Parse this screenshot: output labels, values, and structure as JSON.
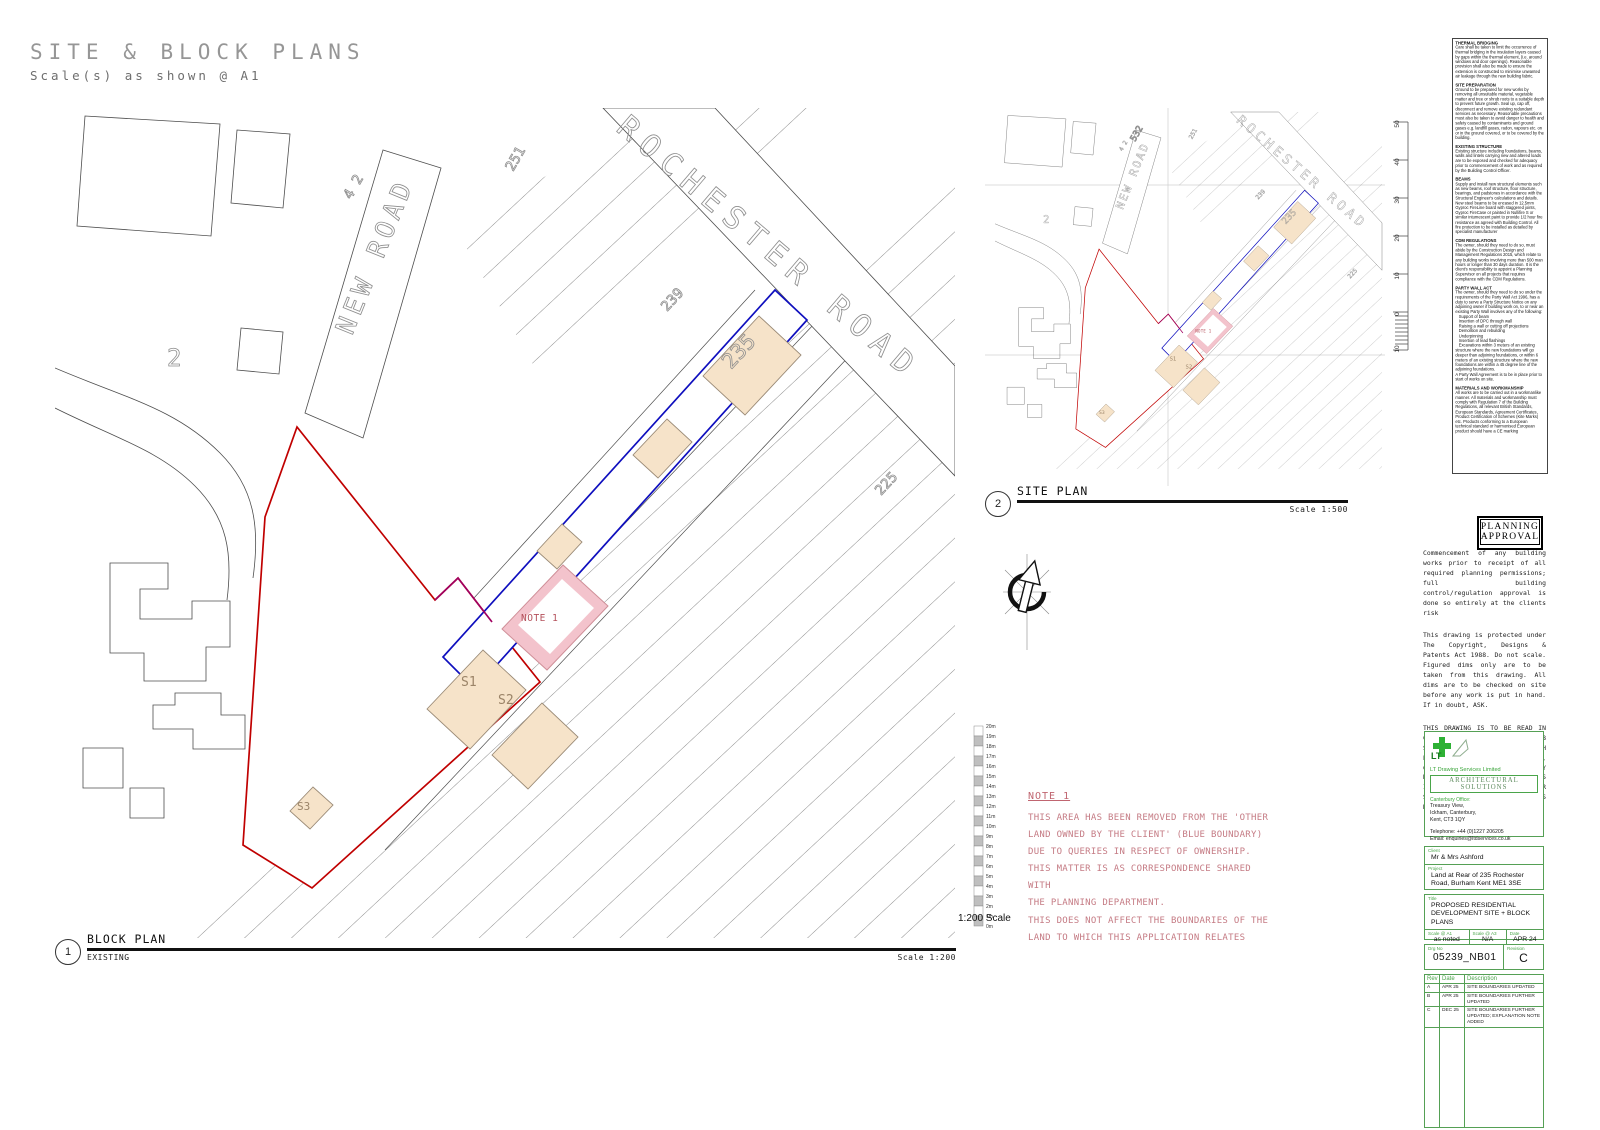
{
  "header": {
    "title": "SITE & BLOCK PLANS",
    "subtitle": "Scale(s) as shown @ A1"
  },
  "colors": {
    "application_boundary_red": "#c00000",
    "other_land_boundary_blue": "#0f0fbe",
    "parcel_fill_beige": "#f6e3c9",
    "note_area_pink": "#f3c3cc",
    "title_block_green": "#55a055",
    "note_text_pink": "#c57b84"
  },
  "block_plan": {
    "callout_number": "1",
    "title": "BLOCK PLAN",
    "status": "EXISTING",
    "scale": "Scale 1:200",
    "road_labels": {
      "new_road": "NEW ROAD",
      "rochester_road": "ROCHESTER ROAD"
    },
    "house_numbers": {
      "n2": "2",
      "n42": "4 2",
      "n251": "251",
      "n239": "239",
      "n235": "235",
      "n225": "225"
    },
    "plot_labels": {
      "s1": "S1",
      "s2": "S2",
      "s3": "S3",
      "note1": "NOTE 1"
    }
  },
  "site_plan": {
    "callout_number": "2",
    "title": "SITE PLAN",
    "scale": "Scale 1:500",
    "extra_house_number": "532",
    "scale_bar_ticks": [
      "50",
      "40",
      "30",
      "20",
      "10",
      "0",
      "10"
    ]
  },
  "north_arrow": {
    "label": "N"
  },
  "scale_bar": {
    "label": "1:200 Scale",
    "ticks": [
      "20m",
      "19m",
      "18m",
      "17m",
      "16m",
      "15m",
      "14m",
      "13m",
      "12m",
      "11m",
      "10m",
      "9m",
      "8m",
      "7m",
      "6m",
      "5m",
      "4m",
      "3m",
      "2m",
      "1m",
      "0m"
    ]
  },
  "note1": {
    "title": "NOTE 1",
    "body": "THIS AREA HAS BEEN REMOVED FROM THE 'OTHER\nLAND OWNED BY THE CLIENT' (BLUE BOUNDARY)\nDUE TO QUERIES IN RESPECT OF OWNERSHIP.\nTHIS MATTER IS AS CORRESPONDENCE SHARED WITH\nTHE PLANNING DEPARTMENT.\nTHIS DOES NOT AFFECT THE BOUNDARIES OF THE\nLAND TO WHICH THIS APPLICATION RELATES"
  },
  "notes_panel": {
    "sections": [
      {
        "heading": "THERMAL BRIDGING",
        "body": "Care shall be taken to limit the occurrence of thermal bridging in the insulation layers caused by gaps within the thermal element, (i.e. around windows and door openings). Reasonable provision shall also be made to ensure the extension is constructed to minimise unwanted air leakage through the new building fabric."
      },
      {
        "heading": "SITE PREPARATION",
        "body": "Ground to be prepared for new works by removing all unsuitable material, vegetable matter and tree or shrub roots to a suitable depth to prevent future growth. Seal up, cap off, disconnect and remove existing redundant services as necessary. Reasonable precautions must also be taken to avoid danger to health and safety caused by contaminants and ground gases e.g. landfill gases, radon, vapours etc. on or in the ground covered, or to be covered by the building."
      },
      {
        "heading": "EXISTING STRUCTURE",
        "body": "Existing structure including foundations, beams, walls and lintels carrying new and altered loads are to be exposed and checked for adequacy prior to commencement of work and as required by the Building Control Officer."
      },
      {
        "heading": "BEAMS",
        "body": "Supply and install new structural elements such as new beams, roof structure, floor structure, bearings, and padstones in accordance with the Structural Engineer's calculations and details. New steel beams to be encased in 12.5mm Gyproc FireLine board with staggered joints, Gyproc FireCase or painted in Nullifire S or similar intumescent paint to provide 1/2 hour fire resistance as agreed with Building Control. All fire protection to be installed as detailed by specialist manufacturer"
      },
      {
        "heading": "CDM REGULATIONS",
        "body": "The owner, should they need to do so, must abide by the Construction Design and Management Regulations 2015, which relate to any building works involving more than 500 man hours or longer than 30 days duration. It is the client's responsibility to appoint a Planning Supervisor on all projects that requires compliance with the CDM Regulations."
      },
      {
        "heading": "PARTY WALL ACT",
        "body": "The owner, should they need to do so under the requirements of the Party Wall Act 1996, has a duty to serve a Party Structure Notice on any adjoining owner if building work on, to or near an existing Party Wall involves any of the following:\n   Support of beam\n   Insertion of DPC through wall\n   Raising a wall or cutting off projections\n   Demolition and rebuilding\n   Underpinning\n   Insertion of lead flashings\n   Excavations within 3 meters of an existing structure where the new foundations will go deeper than adjoining foundations, or within 6 meters of an existing structure where the new foundations are within a 45 degree line of the adjoining foundations.\nA Party Wall Agreement is to be in place prior to start of works on site."
      },
      {
        "heading": "MATERIALS AND WORKMANSHIP",
        "body": "All works are to be carried out in a workmanlike manner. All materials and workmanship must comply with Regulation 7 of the Building Regulations, all relevant British Standards, European Standards, Agreement Certificates, Product Certification of Schemes (Kite Marks) etc. Products conforming to a European technical standard or harmonised European product should have a CE marking"
      }
    ]
  },
  "stamp": {
    "line1": "PLANNING",
    "line2": "APPROVAL"
  },
  "legal": {
    "p1": "Commencement of any building works prior to receipt of all required planning permissions; full building control/regulation approval is done so entirely at the clients risk",
    "p2": "This drawing is protected under The Copyright, Designs & Patents Act 1988. Do not scale. Figured dims only are to be taken from this drawing. All dims are to be checked on site before any work is put in hand. If in doubt, ASK.",
    "p3": "THIS DRAWING IS TO BE READ IN CONJUNCTION WITH JOB SPECIFICATION TOGETHER WITH ENGINEERING / SITE LAYOUT, CONSTRUCTION NOTES, ANY RELEVANT STRUCTURAL ENGINEERS INFORMATION, M&E AND OTHER SPECIALIST CONTRACTORS DRAWINGS."
  },
  "firm": {
    "logo_text": "LT",
    "name": "LT Drawing Services Limited",
    "tagline": "ARCHITECTURAL SOLUTIONS",
    "office_label": "Canterbury Office:",
    "address_lines": [
      "Treasury View,",
      "Ickham, Canterbury,",
      "Kent, CT3 1QY"
    ],
    "telephone": "Telephone: +44 (0)1227 206205",
    "email": "Email: enquiries@ltdservices.co.uk"
  },
  "title_block": {
    "client_label": "Client",
    "client": "Mr & Mrs Ashford",
    "project_label": "Project",
    "project": "Land at Rear of 235 Rochester Road, Burham Kent ME1 3SE",
    "title_label": "Title",
    "title": "PROPOSED RESIDENTIAL DEVELOPMENT SITE + BLOCK PLANS",
    "scale_a1_label": "Scale @ A1",
    "scale_a1": "as noted",
    "scale_a3_label": "Scale @ A3",
    "scale_a3": "N/A",
    "date_label": "Date",
    "date": "APR 24",
    "drg_no_label": "Drg No",
    "drg_no": "05239_NB01",
    "revision_label": "Revision",
    "revision": "C"
  },
  "rev_table": {
    "headers": [
      "Rev",
      "Date",
      "Description"
    ],
    "rows": [
      [
        "A",
        "APR 25",
        "SITE BOUNDARIES UPDATED"
      ],
      [
        "B",
        "APR 25",
        "SITE BOUNDARIES FURTHER UPDATED"
      ],
      [
        "C",
        "DEC 25",
        "SITE BOUNDARIES FURTHER UPDATED; EXPLANATION NOTE ADDED"
      ]
    ]
  }
}
